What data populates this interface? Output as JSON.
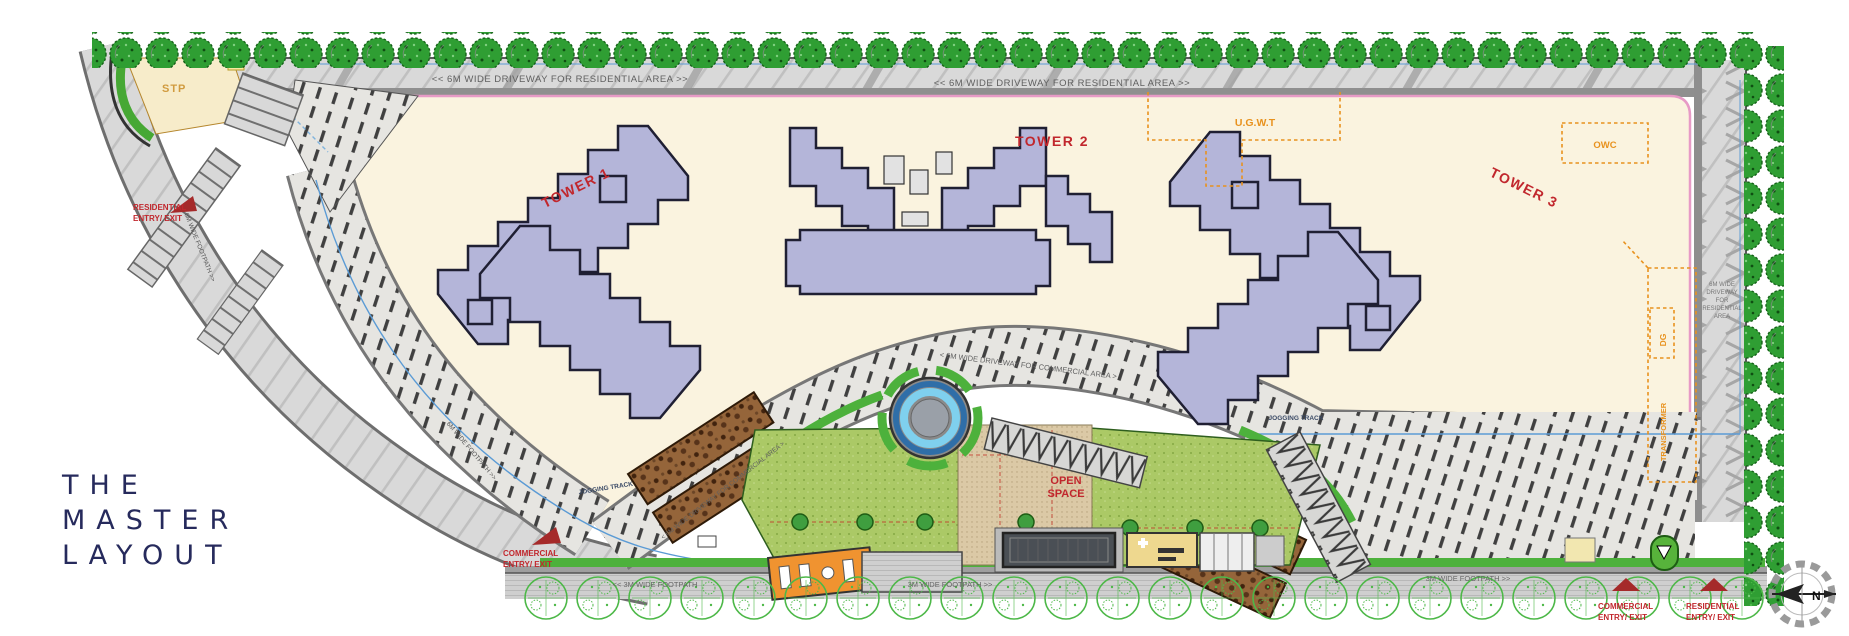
{
  "title": {
    "line1": "THE",
    "line2": "MASTER",
    "line3": "LAYOUT"
  },
  "plan": {
    "towers": [
      {
        "label": "TOWER 1"
      },
      {
        "label": "TOWER 2"
      },
      {
        "label": "TOWER 3"
      }
    ],
    "utilities": {
      "stp": "STP",
      "ugwt": "U.G.W.T",
      "owc": "OWC",
      "dg": "DG",
      "transformer": "TRANSFORMER"
    },
    "open_space_line1": "OPEN",
    "open_space_line2": "SPACE",
    "entries": {
      "residential_top_line1": "RESIDENTIAL",
      "residential_top_line2": "ENTRY/ EXIT",
      "commercial_left_line1": "COMMERCIAL",
      "commercial_left_line2": "ENTRY/ EXIT",
      "commercial_bottom_line1": "COMMERCIAL",
      "commercial_bottom_line2": "ENTRY/ EXIT",
      "residential_bottom_line1": "RESIDENTIAL",
      "residential_bottom_line2": "ENTRY/ EXIT"
    },
    "roads": {
      "top_driveway_label_1": "<<   6M WIDE DRIVEWAY FOR RESIDENTIAL AREA   >>",
      "top_driveway_label_2": "<<   6M WIDE DRIVEWAY FOR RESIDENTIAL AREA   >>",
      "right_driveway_lines": [
        "6M WIDE",
        "DRIVEWAY",
        "FOR",
        "RESIDENTIAL",
        "AREA"
      ],
      "inner_driveway_label": "<   6M WIDE DRIVEWAY FOR COMMERCIAL AREA   >",
      "left_footpath_label": "6M WIDE FOOTPATH   >>",
      "bottom_footpath_labels": [
        "<<   3M WIDE FOOTPATH",
        "3M WIDE FOOTPATH   >>",
        "3M WIDE FOOTPATH   >>"
      ],
      "jogging_track_label_1": "JOGGING TRACK",
      "jogging_track_label_2": "JOGGING TRACK"
    },
    "compass_north": "N"
  },
  "colors": {
    "brand_navy": "#262a5c",
    "label_red": "#c1272d",
    "utility_orange": "#e8921e",
    "tower_fill": "#b4b5d9",
    "site_cream": "#faf3df",
    "tree_green": "#2f9e33",
    "lawn_green": "#a5c75d",
    "boundary_pink": "#e79ac6",
    "water_blue": "#5b9bd5"
  }
}
